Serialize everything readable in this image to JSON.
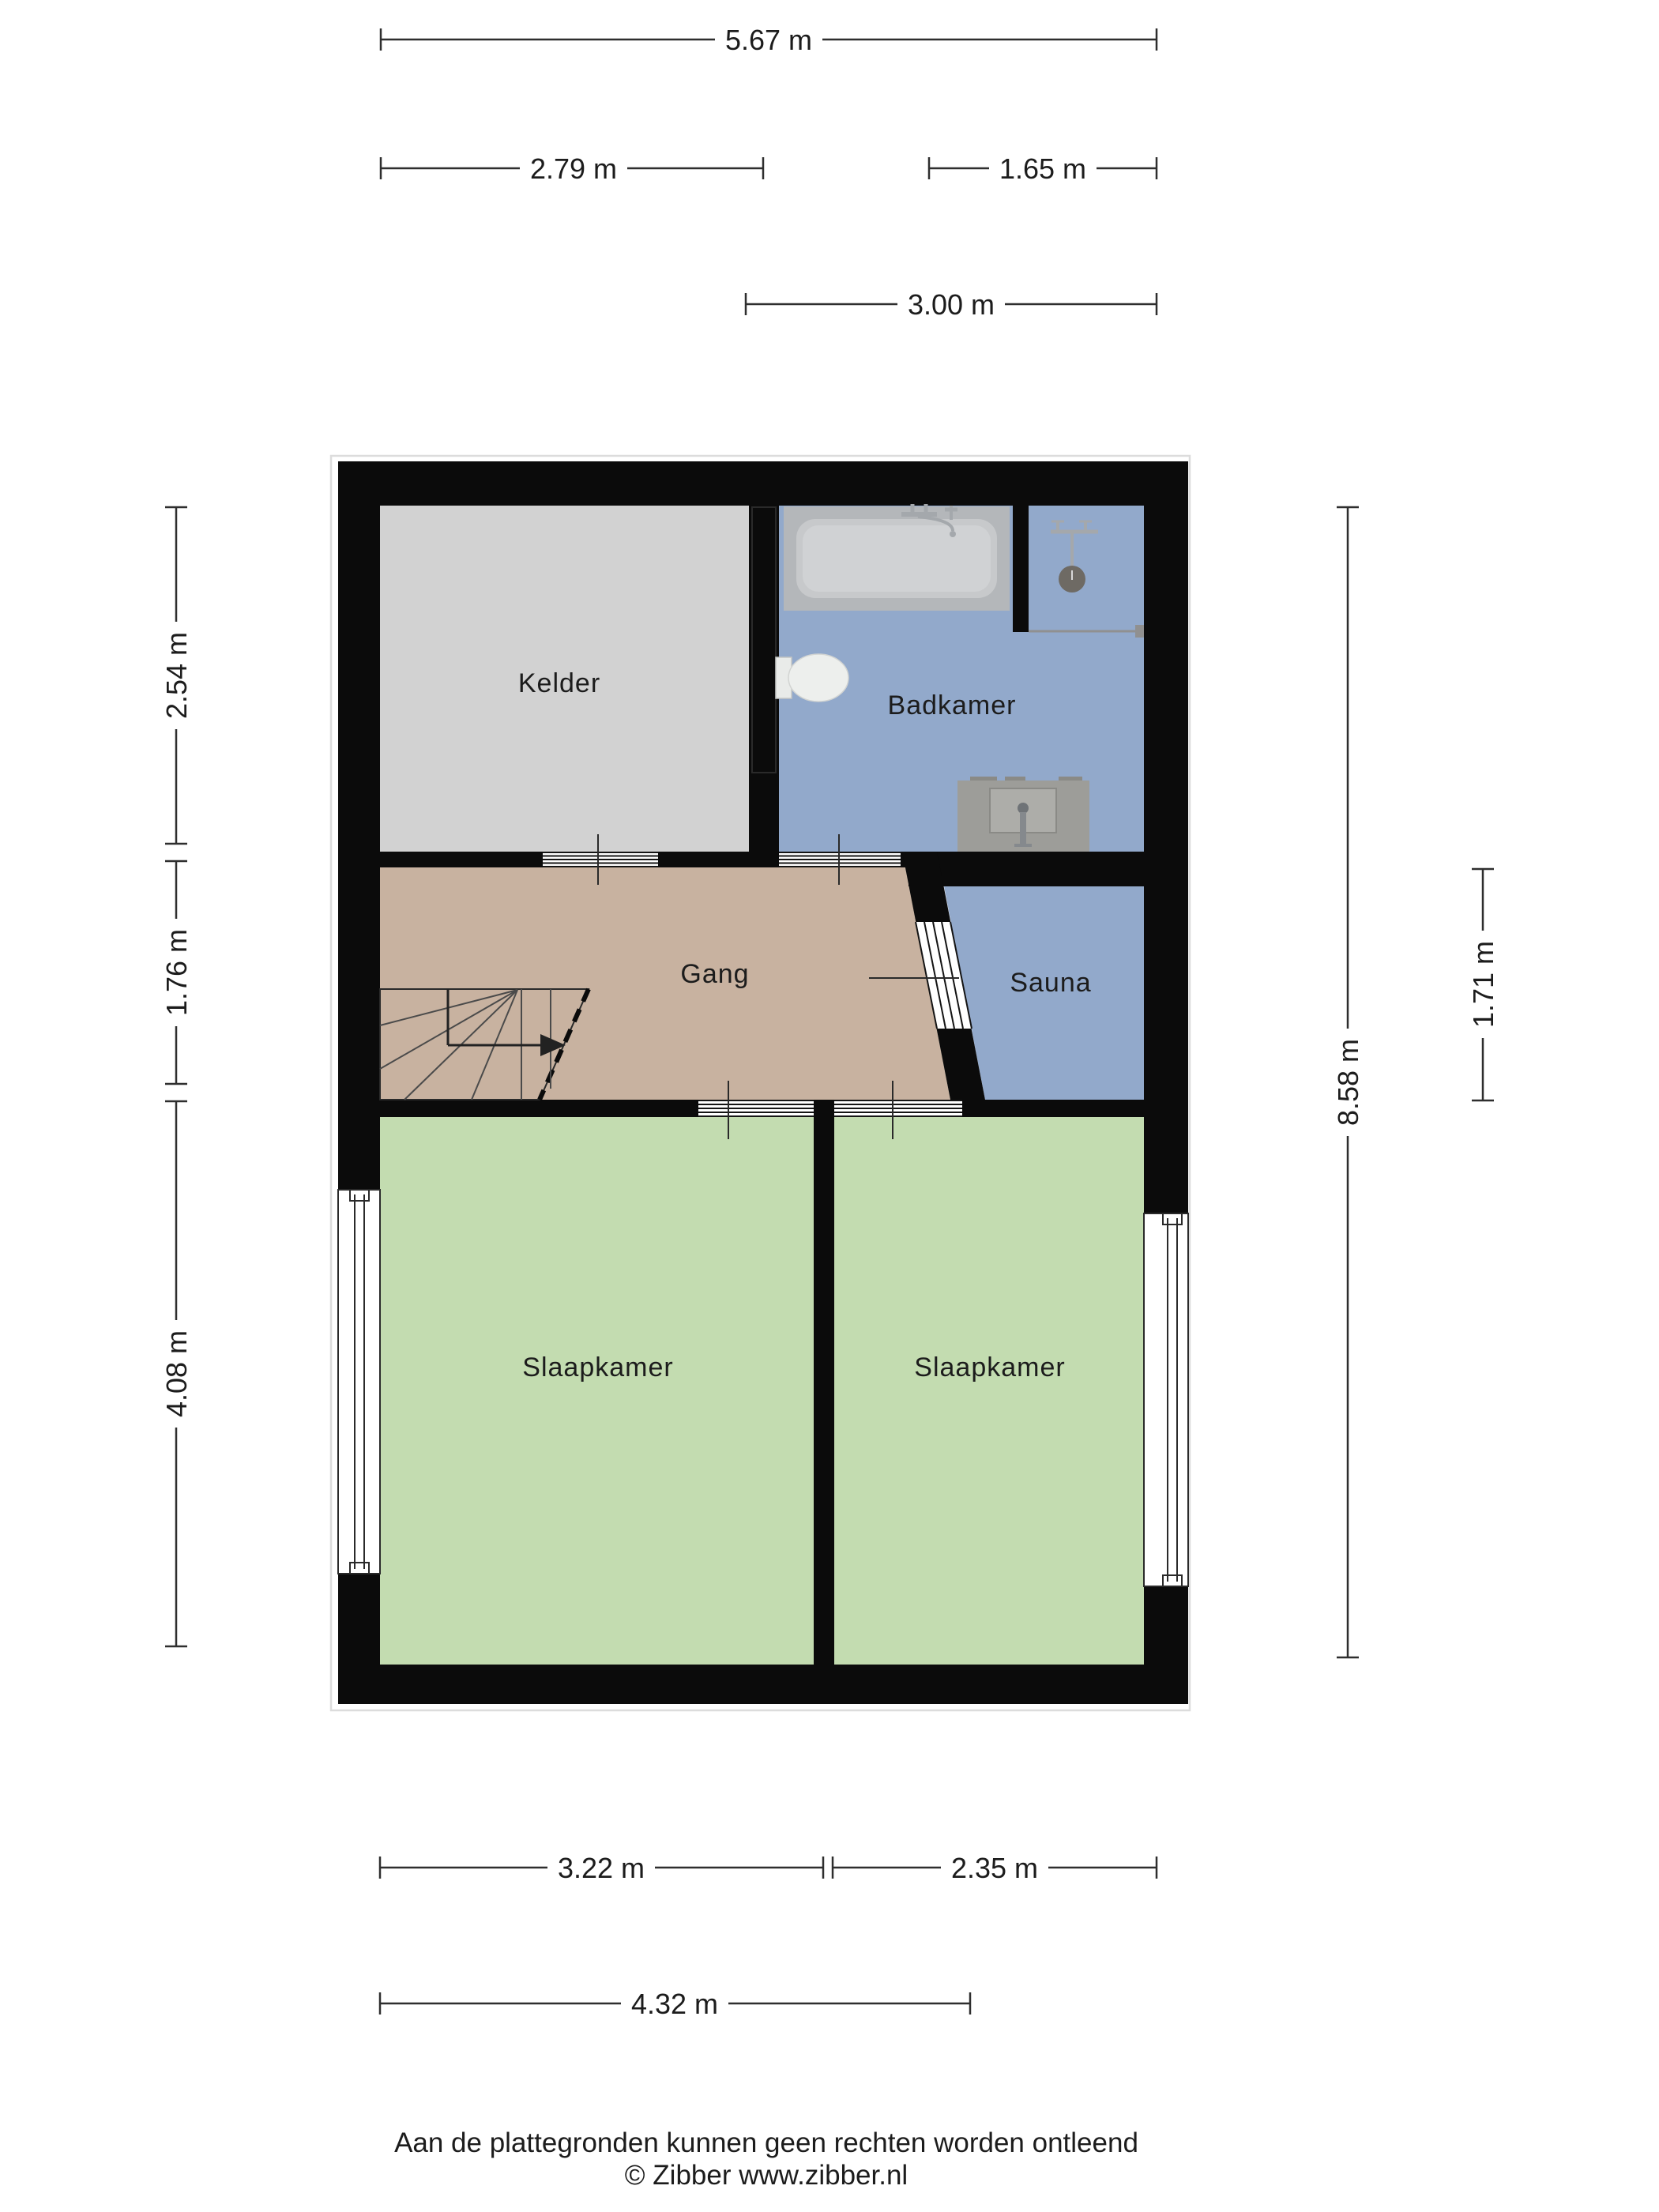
{
  "rooms": {
    "kelder": {
      "label": "Kelder"
    },
    "badkamer": {
      "label": "Badkamer"
    },
    "gang": {
      "label": "Gang"
    },
    "sauna": {
      "label": "Sauna"
    },
    "slaapkamer_left": {
      "label": "Slaapkamer"
    },
    "slaapkamer_right": {
      "label": "Slaapkamer"
    }
  },
  "dims": {
    "top_total": {
      "label": "5.67 m"
    },
    "top_kelder": {
      "label": "2.79 m"
    },
    "top_shower": {
      "label": "1.65 m"
    },
    "top_badkamer": {
      "label": "3.00 m"
    },
    "left_kelder": {
      "label": "2.54 m"
    },
    "left_gang": {
      "label": "1.76 m"
    },
    "left_slaapkamer": {
      "label": "4.08 m"
    },
    "right_total": {
      "label": "8.58 m"
    },
    "right_sauna": {
      "label": "1.71 m"
    },
    "bottom_slaapkamer_left": {
      "label": "3.22 m"
    },
    "bottom_slaapkamer_right": {
      "label": "2.35 m"
    },
    "bottom_total": {
      "label": "4.32 m"
    }
  },
  "footer": {
    "disclaimer": "Aan de plattegronden kunnen geen rechten worden ontleend",
    "copyright": "© Zibber www.zibber.nl"
  },
  "colors": {
    "wall": "#0b0b0b",
    "kelder": "#d2d2d2",
    "badkamer": "#92a9cb",
    "sauna": "#92a9cb",
    "gang": "#c8b2a0",
    "bedroom": "#c3dcb0",
    "tub_pad": "#b4b7ba",
    "tub_inner": "#c7c9cb",
    "tub_inner2": "#d0d2d4",
    "sink_pad": "#9d9d99",
    "sink_inner": "#adada9",
    "chrome": "#a4a8ac",
    "shower_head": "#6e6a64",
    "dim": "#2e2e2e",
    "text": "#1c1c1c",
    "frame": "#dcdcdc"
  }
}
